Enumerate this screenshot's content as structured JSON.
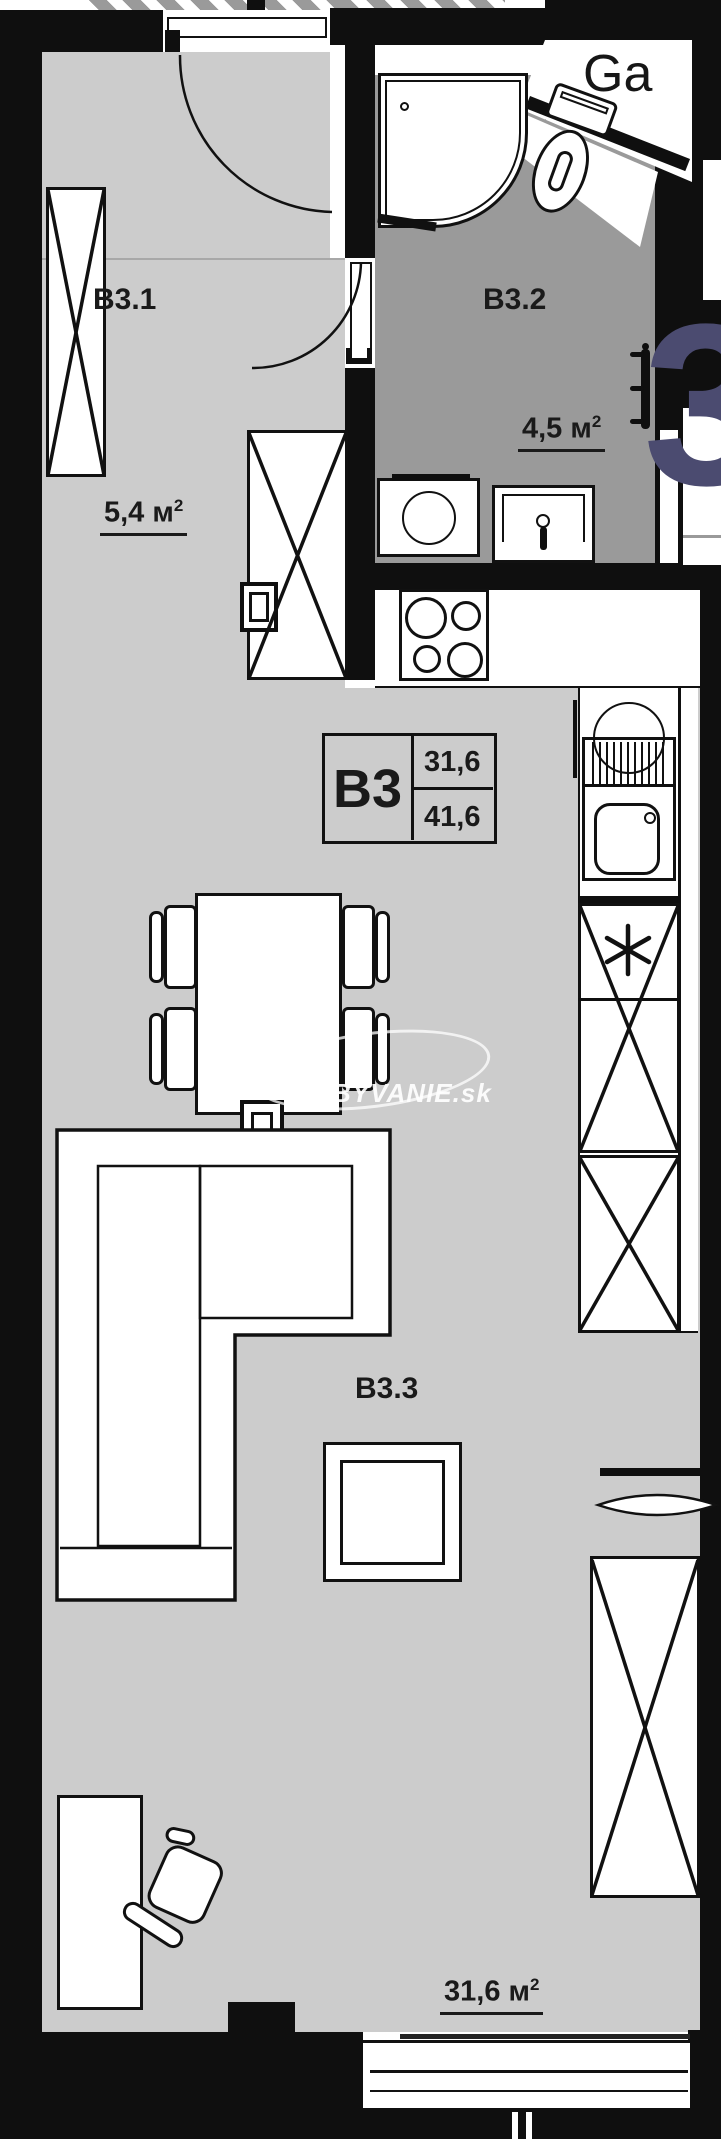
{
  "plan": {
    "unit_code": "B3",
    "neighbor_label": "Ga",
    "rooms": [
      {
        "id": "B3.1",
        "area_value": "5,4",
        "area_unit": "м",
        "area_sup": "2"
      },
      {
        "id": "B3.2",
        "area_value": "4,5",
        "area_unit": "м",
        "area_sup": "2"
      },
      {
        "id": "B3.3",
        "area_value": "31,6",
        "area_unit": "м",
        "area_sup": "2"
      }
    ],
    "legend": {
      "code": "B3",
      "value_top": "31,6",
      "value_bottom": "41,6"
    },
    "watermark": {
      "text": "BYVANIE.sk",
      "glyph": "3"
    },
    "colors": {
      "floor": "#cccccc",
      "bath_floor": "#9a9a9a",
      "wall": "#0f0f0f",
      "accent_navy": "#4b4b70"
    }
  }
}
